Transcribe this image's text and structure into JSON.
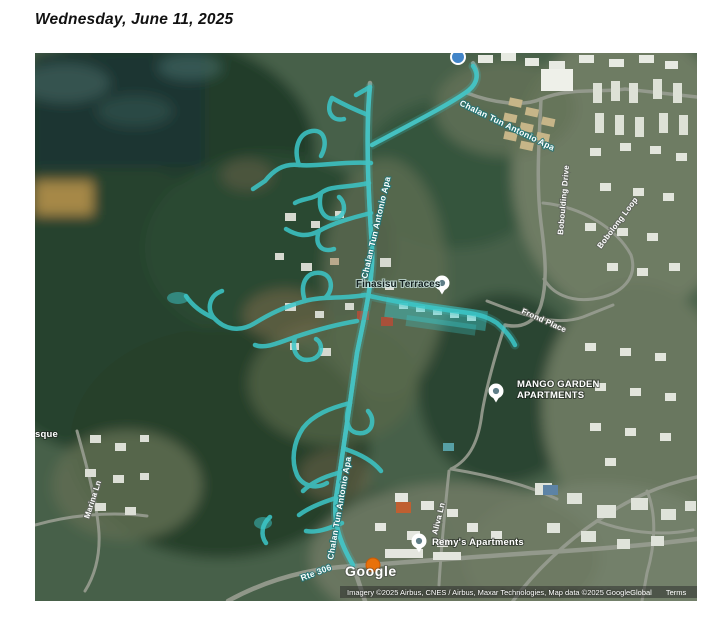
{
  "page": {
    "date_heading": "Wednesday, June 11, 2025"
  },
  "map": {
    "road_labels": {
      "chalan_top": "Chalan Tun Antonio Apa",
      "chalan_mid": "Chalan Tun Antonio Apa",
      "chalan_lower": "Chalan Tun Antonio Apa",
      "boboulding_drive": "Boboulding Drive",
      "bobolong_loop": "Bobolong Loop",
      "frond_place": "Frond Place",
      "marina_ln": "Marina Ln",
      "aliva_ln": "Aliva Ln",
      "rte_306": "Rte 306",
      "partial_left_edge": "sque"
    },
    "pois": {
      "finasisu_terraces": "Finasisu Terraces",
      "mango_garden_line1": "MANGO GARDEN",
      "mango_garden_line2": "APARTMENTS",
      "remys_apartments": "Remy's Apartments"
    },
    "watermark": "Google",
    "attribution": {
      "imagery": "Imagery ©2025 Airbus, CNES / Airbus, Maxar Technologies, Map data ©2025 Google",
      "links": [
        "Global",
        "Terms",
        "Privacy"
      ]
    },
    "colors": {
      "track_highlight": "#3cc7c9",
      "pin_dot": "#5f7e88",
      "marker_orange": "#e8710a",
      "poi_blue": "#4285c8"
    }
  }
}
